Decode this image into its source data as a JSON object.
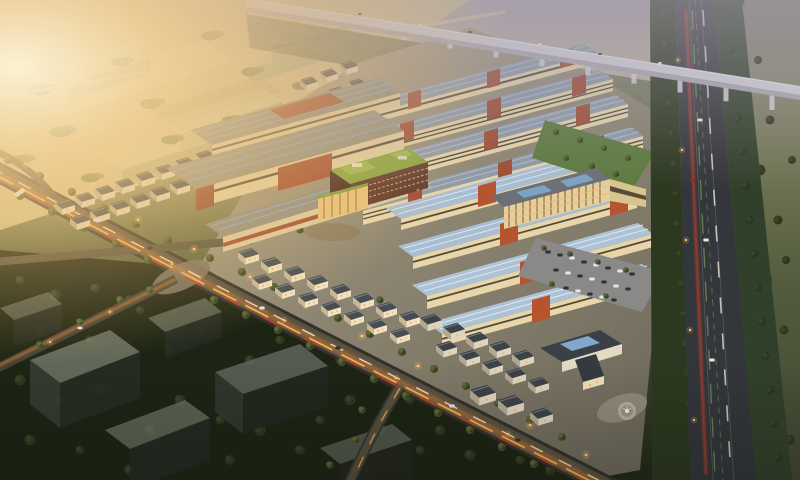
{
  "meta": {
    "title": "Aerial dusk rendering of a planned industrial park masterplan",
    "type": "architectural-visualization",
    "view": "aerial-oblique bird's-eye",
    "time_of_day": "dusk with golden sunset glow from the left"
  },
  "scene": {
    "regions": [
      {
        "name": "farmland-fields",
        "description": "Hazy golden farm fields with tree rows and translucent future-phase massing blocks, upper left"
      },
      {
        "name": "viaduct-bridge",
        "description": "Elevated expressway viaduct on piers crossing the upper right, shrouded in haze"
      },
      {
        "name": "expressway",
        "description": "Multi-lane expressway running down the right side with red and white vehicle light trails and tree verges"
      },
      {
        "name": "main-avenue",
        "description": "Wide boulevard crossing diagonally from upper left to lower right with street trees, lamps and warm light trails"
      },
      {
        "name": "factory-rows",
        "description": "Parallel rows of multi-storey factory buildings with blue roofs, cream facades and red-brick stair towers, upper center"
      },
      {
        "name": "warehouse-halls",
        "description": "Large warehouse halls with skylight-striped roofs and red-brick entrances, center left"
      },
      {
        "name": "green-roof-building",
        "description": "Central mid-rise headquarters with planted green roof, red-brick facade and glowing glass podium"
      },
      {
        "name": "retail-village",
        "description": "Clusters of small traditional-style houses and shops with dark pitched roofs and lit windows"
      },
      {
        "name": "parking-lot",
        "description": "Surface parking lot with rows of cars and trees, center right"
      },
      {
        "name": "fountain-plaza",
        "description": "Circular fountain plaza near the south gate building"
      },
      {
        "name": "reserved-massing-blocks",
        "description": "Dark translucent reserved-plot massing blocks among dense trees, lower left"
      }
    ]
  },
  "palette": {
    "sun-glow": "#ffe9bb",
    "haze": "#a7a0ae",
    "field-tan": "#cdbd8d",
    "tree-olive": "#6b7247",
    "tree-green": "#46522c",
    "tree-dark": "#2c371e",
    "ground-dark": "#1d2414",
    "site-ground": "#a0988a",
    "road-asphalt": "#575040",
    "trail-orange": "#ffab4e",
    "trail-red": "#d43a22",
    "trail-white": "#ffe9c2",
    "roof-blue": "#a9bed2",
    "roof-slate": "#3d4247",
    "wall-cream": "#e8d6a8",
    "brick-red": "#9a4a32",
    "brick-orange": "#b5542f",
    "green-roof": "#86a53f",
    "lawn": "#5c7a3e",
    "viaduct-grey": "#d2d2d8"
  }
}
